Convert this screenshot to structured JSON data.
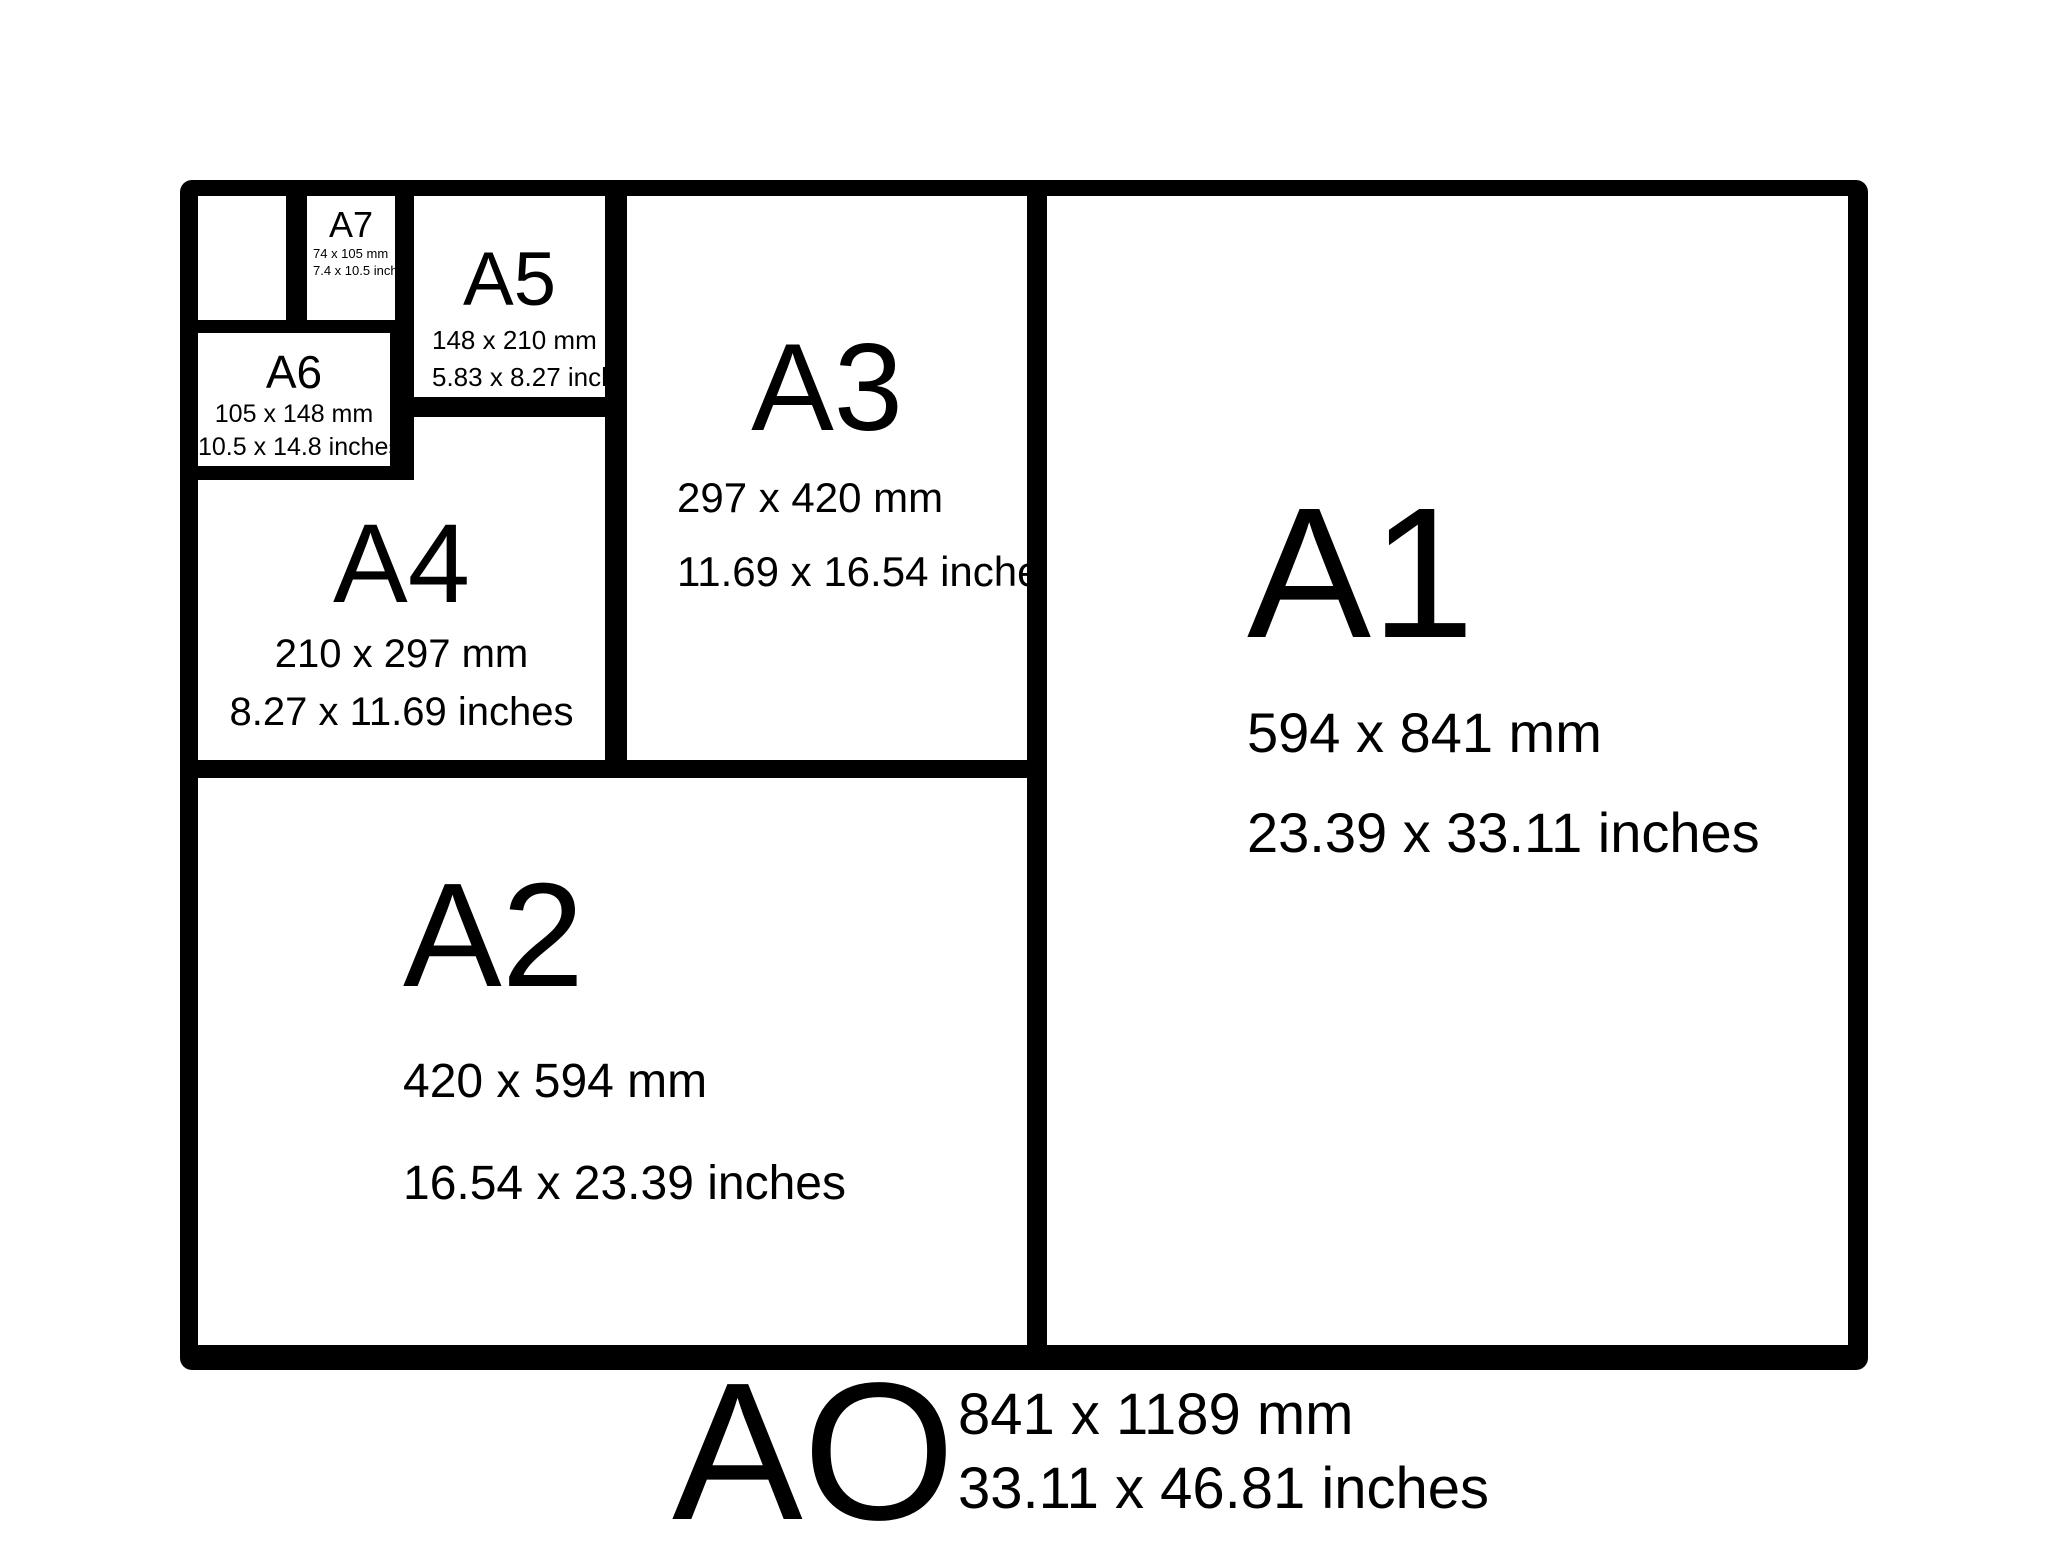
{
  "colors": {
    "frame": "#000000",
    "paper": "#ffffff",
    "text": "#000000"
  },
  "boxes": {
    "a1": {
      "label": "A1",
      "mm": "594 x 841 mm",
      "inches": "23.39 x 33.11 inches"
    },
    "a2": {
      "label": "A2",
      "mm": "420 x 594 mm",
      "inches": "16.54 x 23.39 inches"
    },
    "a3": {
      "label": "A3",
      "mm": "297 x 420 mm",
      "inches": "11.69 x 16.54 inches"
    },
    "a4": {
      "label": "A4",
      "mm": "210 x 297 mm",
      "inches": "8.27 x 11.69 inches"
    },
    "a5": {
      "label": "A5",
      "mm": "148 x 210 mm",
      "inches": "5.83 x 8.27 inches"
    },
    "a6": {
      "label": "A6",
      "mm": "105 x 148 mm",
      "inches": "10.5 x 14.8 inches"
    },
    "a7": {
      "label": "A7",
      "mm": "74 x 105 mm",
      "inches": "7.4 x 10.5 inches"
    },
    "a8": {
      "label": ""
    }
  },
  "footer": {
    "label": "AO",
    "mm": "841 x 1189 mm",
    "inches": "33.11 x 46.81 inches"
  }
}
